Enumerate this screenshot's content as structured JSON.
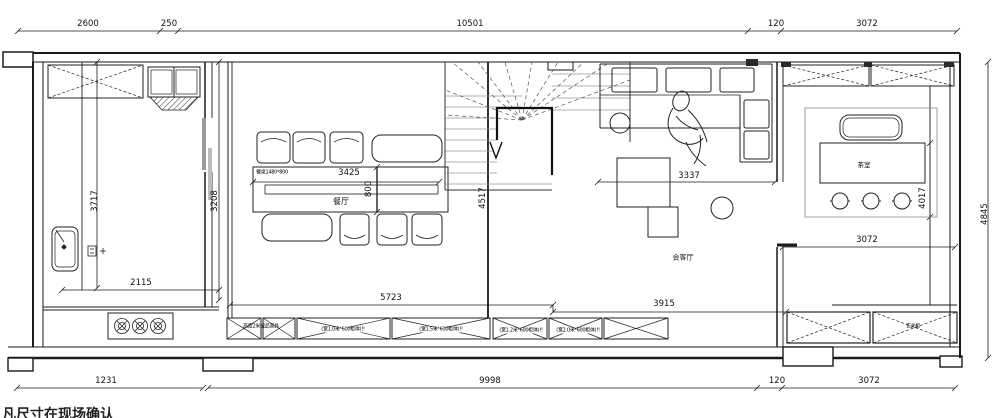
{
  "colors": {
    "line": "#1a1a1a",
    "background": "#ffffff"
  },
  "footer_note": "凡尺寸在现场确认",
  "dim_labels": [
    {
      "text": "2600",
      "x": 88,
      "y": 24,
      "rot": 0
    },
    {
      "text": "250",
      "x": 169,
      "y": 24,
      "rot": 0
    },
    {
      "text": "10501",
      "x": 470,
      "y": 24,
      "rot": 0
    },
    {
      "text": "120",
      "x": 776,
      "y": 24,
      "rot": 0
    },
    {
      "text": "3072",
      "x": 867,
      "y": 24,
      "rot": 0
    },
    {
      "text": "3717",
      "x": 95,
      "y": 201,
      "rot": -90
    },
    {
      "text": "3208",
      "x": 215,
      "y": 201,
      "rot": -90
    },
    {
      "text": "2115",
      "x": 141,
      "y": 283,
      "rot": 0
    },
    {
      "text": "3425",
      "x": 349,
      "y": 173,
      "rot": 0
    },
    {
      "text": "800",
      "x": 369,
      "y": 189,
      "rot": -90
    },
    {
      "text": "4517",
      "x": 483,
      "y": 198,
      "rot": -90
    },
    {
      "text": "3337",
      "x": 689,
      "y": 176,
      "rot": 0
    },
    {
      "text": "3072",
      "x": 867,
      "y": 240,
      "rot": 0
    },
    {
      "text": "4017",
      "x": 923,
      "y": 198,
      "rot": -90
    },
    {
      "text": "4845",
      "x": 985,
      "y": 214,
      "rot": -90
    },
    {
      "text": "5723",
      "x": 391,
      "y": 298,
      "rot": 0
    },
    {
      "text": "3915",
      "x": 664,
      "y": 304,
      "rot": 0
    },
    {
      "text": "1231",
      "x": 106,
      "y": 381,
      "rot": 0
    },
    {
      "text": "9998",
      "x": 490,
      "y": 381,
      "rot": 0
    },
    {
      "text": "120",
      "x": 777,
      "y": 381,
      "rot": 0
    },
    {
      "text": "3072",
      "x": 869,
      "y": 381,
      "rot": 0
    }
  ],
  "room_labels": [
    {
      "text": "餐厅",
      "x": 341,
      "y": 202,
      "size": 8
    },
    {
      "text": "会客厅",
      "x": 683,
      "y": 258,
      "size": 7
    },
    {
      "text": "茶室",
      "x": 864,
      "y": 165,
      "size": 6.5
    }
  ],
  "annotations": [
    {
      "text": "餐桌1480*800",
      "x": 272,
      "y": 173,
      "bg": false
    },
    {
      "text": "高度2米成品家具",
      "x": 261,
      "y": 327,
      "bg": false
    },
    {
      "text": "(宽1.0米*600柜体)!!",
      "x": 343,
      "y": 330,
      "bg": true
    },
    {
      "text": "(宽1.5米*600柜体)!!",
      "x": 441,
      "y": 330,
      "bg": true
    },
    {
      "text": "(宽1.2米*600柜体)!!",
      "x": 521,
      "y": 331,
      "bg": true
    },
    {
      "text": "(宽2.0米*600柜体)!!",
      "x": 578,
      "y": 331,
      "bg": true
    },
    {
      "text": "玄关柜",
      "x": 913,
      "y": 327,
      "bg": false
    }
  ]
}
